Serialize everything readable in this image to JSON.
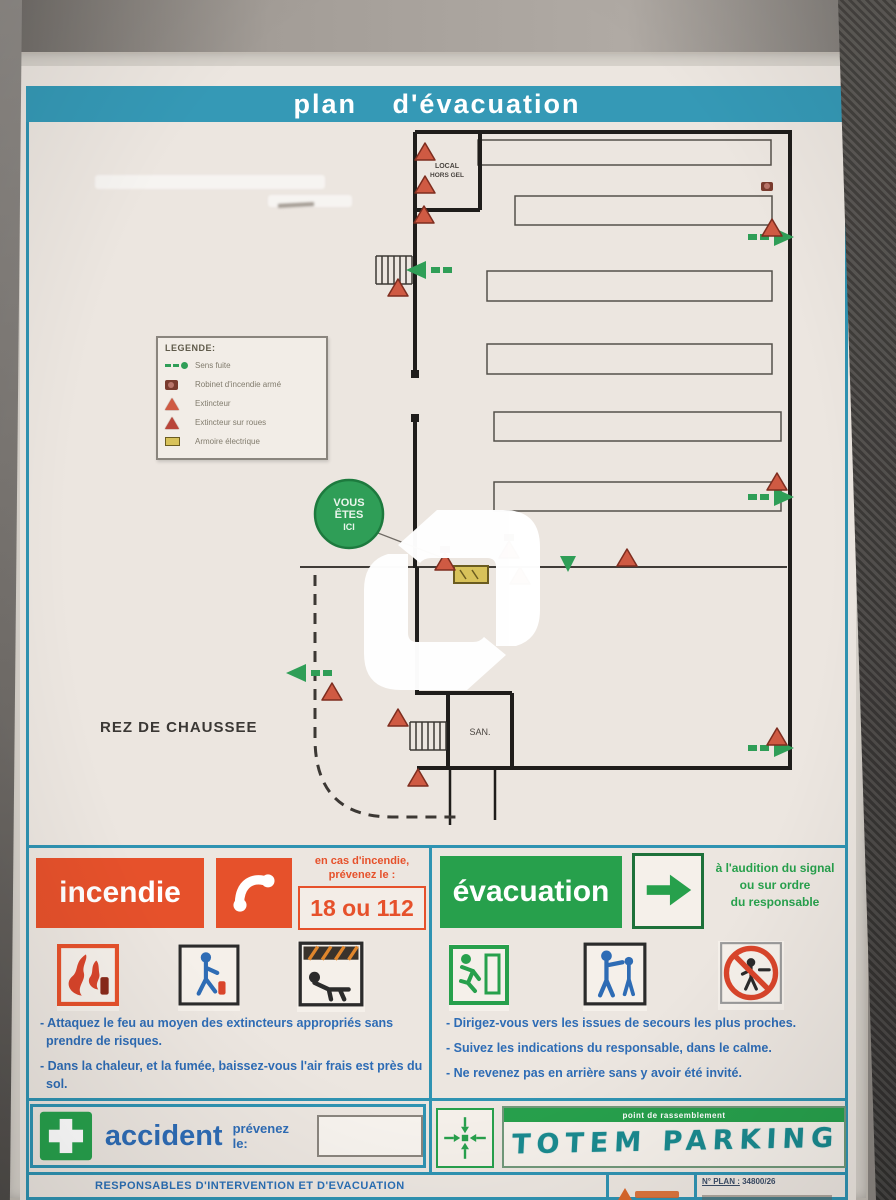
{
  "title": "plan d'évacuation",
  "plan": {
    "floor_label": "REZ DE CHAUSSEE",
    "you_are_here": {
      "line1": "VOUS",
      "line2": "ÊTES",
      "line3": "ICI"
    },
    "rooms": {
      "local_line1": "LOCAL",
      "local_line2": "HORS GEL",
      "san": "SAN."
    },
    "legend": {
      "title": "LEGENDE:",
      "items": [
        {
          "icon": "escape-route",
          "label": "Sens fuite"
        },
        {
          "icon": "fire-hose-reel",
          "label": "Robinet d'incendie armé"
        },
        {
          "icon": "extinguisher",
          "label": "Extincteur"
        },
        {
          "icon": "wheeled-extinguisher",
          "label": "Extincteur sur roues"
        },
        {
          "icon": "electrical-cabinet",
          "label": "Armoire électrique"
        }
      ]
    }
  },
  "incendie": {
    "label": "incendie",
    "notice_line1": "en cas d'incendie,",
    "notice_line2": "prévenez le :",
    "phone": "18 ou 112",
    "instructions": [
      "- Attaquez le feu au moyen des extincteurs appropriés sans prendre de risques.",
      "- Dans la chaleur, et la fumée, baissez-vous l'air frais est près du sol."
    ]
  },
  "evacuation": {
    "label": "évacuation",
    "notice_line1": "à l'audition du signal",
    "notice_line2": "ou sur ordre",
    "notice_line3": "du responsable",
    "instructions": [
      "- Dirigez-vous vers les issues de secours les plus proches.",
      "- Suivez les indications du responsable, dans le calme.",
      "- Ne revenez pas en arrière sans y avoir été invité."
    ]
  },
  "accident": {
    "label": "accident",
    "notice": "prévenez le:",
    "phone_value": ""
  },
  "assembly": {
    "band_label": "point de rassemblement",
    "handwritten": "TOTEM PARKING"
  },
  "footer": {
    "responsables": "RESPONSABLES  D'INTERVENTION ET D'EVACUATION",
    "plan_number_label": "N° PLAN :",
    "plan_number": "34800/26"
  },
  "colors": {
    "band_teal": "#3599b6",
    "border_blue": "#2f93b2",
    "fire_orange": "#e6512b",
    "evac_green": "#27a04c",
    "text_blue": "#2e6cb5",
    "extinguisher_red": "#cf5a43",
    "paper": "#ece6e0"
  }
}
